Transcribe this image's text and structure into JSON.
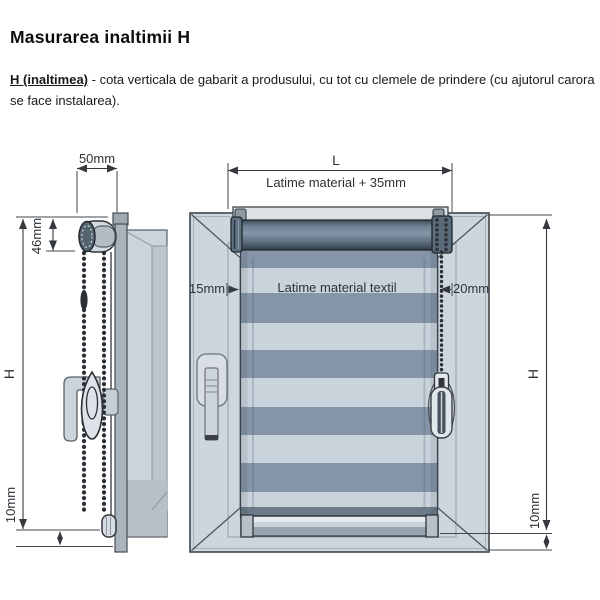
{
  "page": {
    "title": "Masurarea inaltimii H",
    "description": {
      "term": "H (inaltimea)",
      "text": " - cota verticala de gabarit a produsului, cu tot cu clemele de prindere (cu ajutorul carora se face instalarea)."
    }
  },
  "diagram": {
    "side_view": {
      "depth_label": "50mm",
      "mechanism_height_label": "46mm",
      "height_label": "H",
      "bottom_gap_label": "10mm"
    },
    "front_view": {
      "total_width_label": "L",
      "total_width_note": "Latime material + 35mm",
      "left_gap_label": "15mm",
      "fabric_width_label": "Latime material textil",
      "right_gap_label": "20mm",
      "height_label": "H",
      "bottom_gap_label": "10mm"
    },
    "colors": {
      "fabric_dark": "#8595a7",
      "fabric_light": "#c9d3dc",
      "frame": "#ced6dd",
      "frame_shade": "#bdc6ce",
      "tube_dark": "#42525f",
      "metal_light": "#dde2e7",
      "outline": "#3d434a",
      "dimension": "#35393e"
    }
  }
}
